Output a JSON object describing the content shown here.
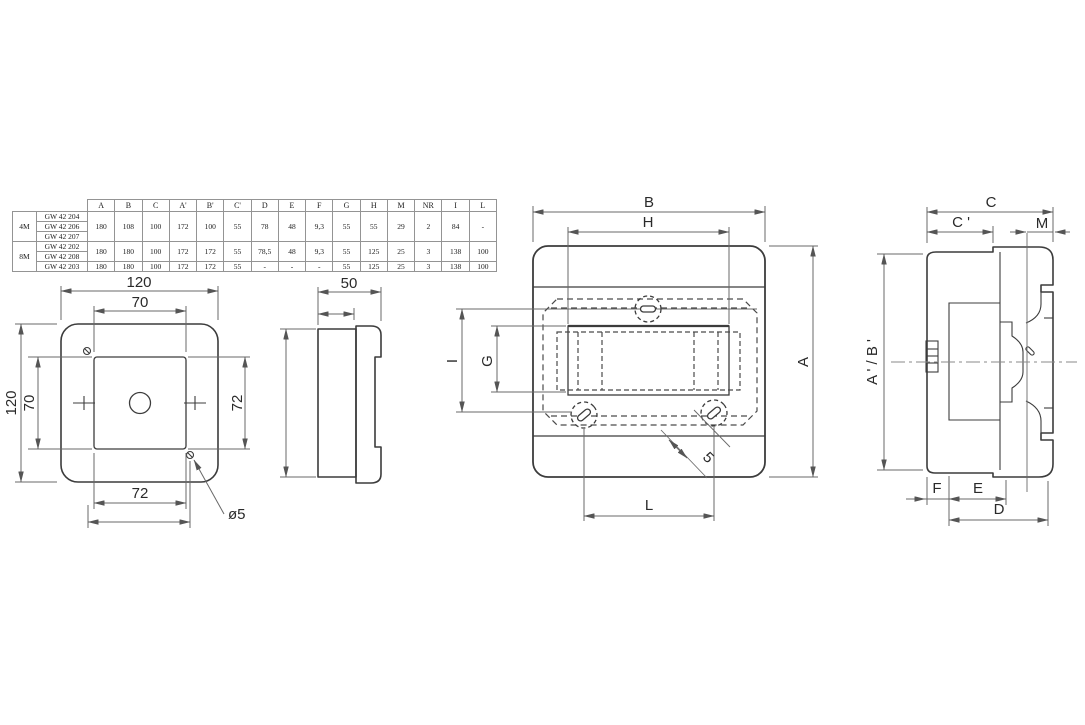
{
  "table": {
    "headers": [
      "A",
      "B",
      "C",
      "A'",
      "B'",
      "C'",
      "D",
      "E",
      "F",
      "G",
      "H",
      "M",
      "NR",
      "I",
      "L"
    ],
    "groups": [
      "4M",
      "8M"
    ],
    "models": [
      "GW 42 204",
      "GW 42 206",
      "GW 42 207",
      "GW 42 202",
      "GW 42 208",
      "GW 42 203"
    ],
    "value_rows": [
      {
        "models": "GW 42 204 / GW 42 206 / GW 42 207",
        "values": [
          "180",
          "108",
          "100",
          "172",
          "100",
          "55",
          "78",
          "48",
          "9,3",
          "55",
          "55",
          "29",
          "2",
          "84",
          "-"
        ]
      },
      {
        "models": "GW 42 202 / GW 42 208",
        "values": [
          "180",
          "180",
          "100",
          "172",
          "172",
          "55",
          "78,5",
          "48",
          "9,3",
          "55",
          "125",
          "25",
          "3",
          "138",
          "100"
        ]
      },
      {
        "models": "GW 42 203",
        "values": [
          "180",
          "180",
          "100",
          "172",
          "172",
          "55",
          "-",
          "-",
          "-",
          "55",
          "125",
          "25",
          "3",
          "138",
          "100"
        ]
      }
    ]
  },
  "front_view": {
    "dim_width_top": "120",
    "dim_inner_width": "70",
    "dim_height_left": "120",
    "dim_inner_height": "70",
    "dim_right": "72",
    "dim_bottom": "72",
    "hole_callout": "ø5"
  },
  "side_view": {
    "dim_depth": "50"
  },
  "panel_view": {
    "dim_b": "B",
    "dim_h": "H",
    "dim_a": "A",
    "dim_l": "L",
    "dim_i": "I",
    "dim_g": "G",
    "dim_slot": "5"
  },
  "section_view": {
    "dim_c": "C",
    "dim_c_prime": "C '",
    "dim_m": "M",
    "dim_a_b_prime": "A ' / B '",
    "dim_f": "F",
    "dim_e": "E",
    "dim_d": "D"
  },
  "colors": {
    "line": "#3c3c3c",
    "dim_line": "#686868",
    "background": "#ffffff"
  }
}
